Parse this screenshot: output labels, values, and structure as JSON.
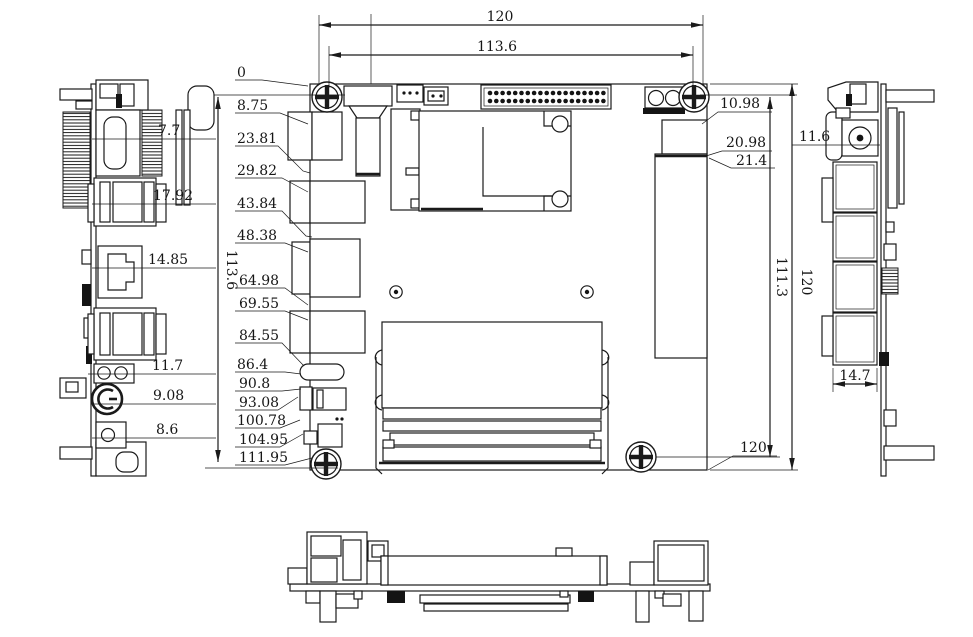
{
  "drawing": {
    "line_color": "#1a1a1a",
    "background": "#ffffff",
    "dims": {
      "top": {
        "overall_width": "120",
        "hole_span_width": "113.6"
      },
      "left_height": "113.6",
      "left_column": [
        "0",
        "8.75",
        "23.81",
        "29.82",
        "43.84",
        "48.38",
        "64.98",
        "69.55",
        "84.55",
        "86.4",
        "90.8",
        "93.08",
        "100.78",
        "104.95",
        "111.95"
      ],
      "right_column": [
        "10.98",
        "20.98",
        "21.4"
      ],
      "right_inner_height": "111.3",
      "right_overall_height": "120",
      "bottom_right_width": "120",
      "left_view": {
        "hdmi": "7.7",
        "usb_top": "17.92",
        "lan": "14.85",
        "terminal": "11.7",
        "dc_jack": "9.08",
        "button": "8.6"
      },
      "right_view": {
        "jack": "11.6",
        "connector_width": "14.7"
      }
    }
  }
}
